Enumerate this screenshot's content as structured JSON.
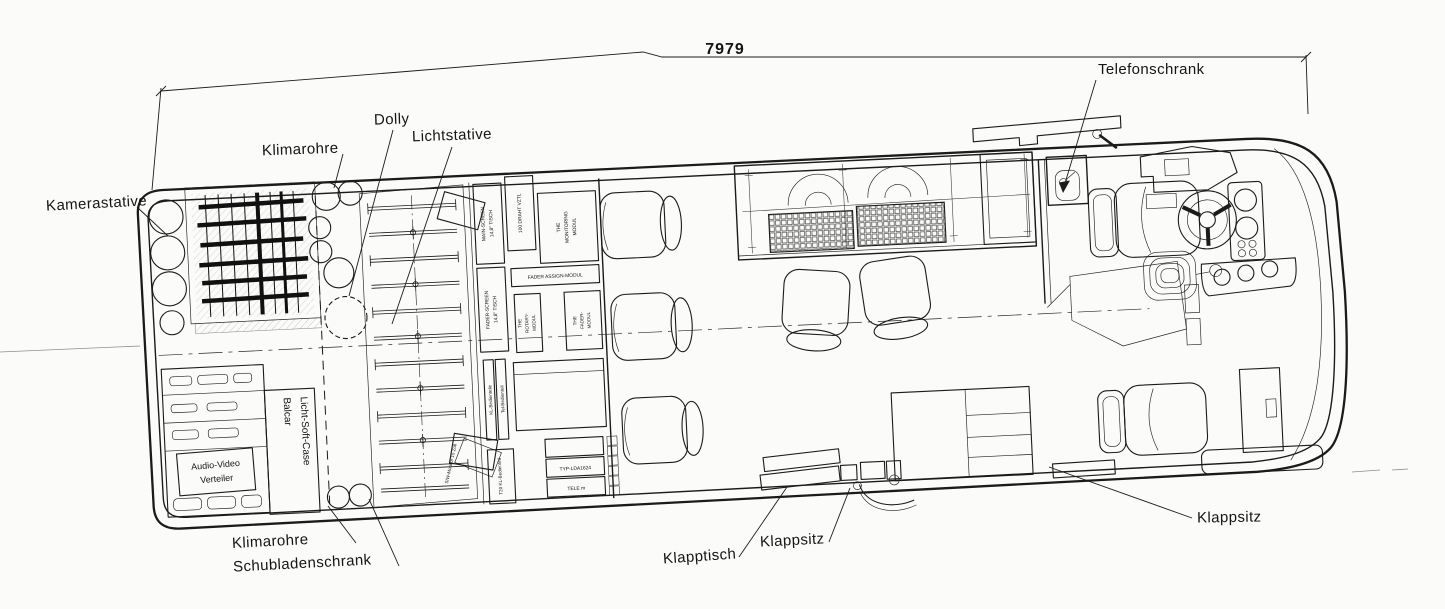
{
  "drawing": {
    "dimension_total": "7979",
    "ink_color": "#1b1b1b",
    "background_color": "#fbfbf9"
  },
  "callouts": [
    {
      "id": "kamerastative",
      "text": "Kamerastative"
    },
    {
      "id": "klimarohre-top",
      "text": "Klimarohre"
    },
    {
      "id": "dolly",
      "text": "Dolly"
    },
    {
      "id": "lichtstative",
      "text": "Lichtstative"
    },
    {
      "id": "telefonschrank",
      "text": "Telefonschrank"
    },
    {
      "id": "klimarohre-bottom",
      "text": "Klimarohre"
    },
    {
      "id": "schubladenschrank",
      "text": "Schubladenschrank"
    },
    {
      "id": "klapptisch",
      "text": "Klapptisch"
    },
    {
      "id": "klappsitz-mid",
      "text": "Klappsitz"
    },
    {
      "id": "klappsitz-right",
      "text": "Klappsitz"
    }
  ],
  "interior_labels": {
    "balcar_line1": "Balcar",
    "balcar_line2": "Licht-Soft-Case",
    "verteiler_line1": "Audio-Video",
    "verteiler_line2": "Verteiler",
    "monitor_box": "S/W-Monitor 15 Zoll"
  },
  "rack_labels": {
    "main_screen_1": "MAIN-SCREEN",
    "main_screen_2": "14,8\" TISCH",
    "draht": "100 DRAHT VZTL",
    "monitoring_1": "THE",
    "monitoring_2": "MONITORING",
    "monitoring_3": "MODUL",
    "fader_assign": "FADER ASSIGN-MODUL",
    "fader_screen_1": "FADER-SCREEN",
    "fader_screen_2": "14,8\" TISCH",
    "rotary_1": "THE",
    "rotary_2": "ROTARY-",
    "rotary_3": "MODUL",
    "fader_1": "THE",
    "fader_2": "FADER-",
    "fader_3": "MODUL",
    "kl_bedien": "KL-Bedienteile",
    "tel_bedien": "Tel-Bedienteil",
    "t20": "T20 KL-Bedienteil",
    "typ": "TYP-LDA1624",
    "tele": "TELE m"
  }
}
